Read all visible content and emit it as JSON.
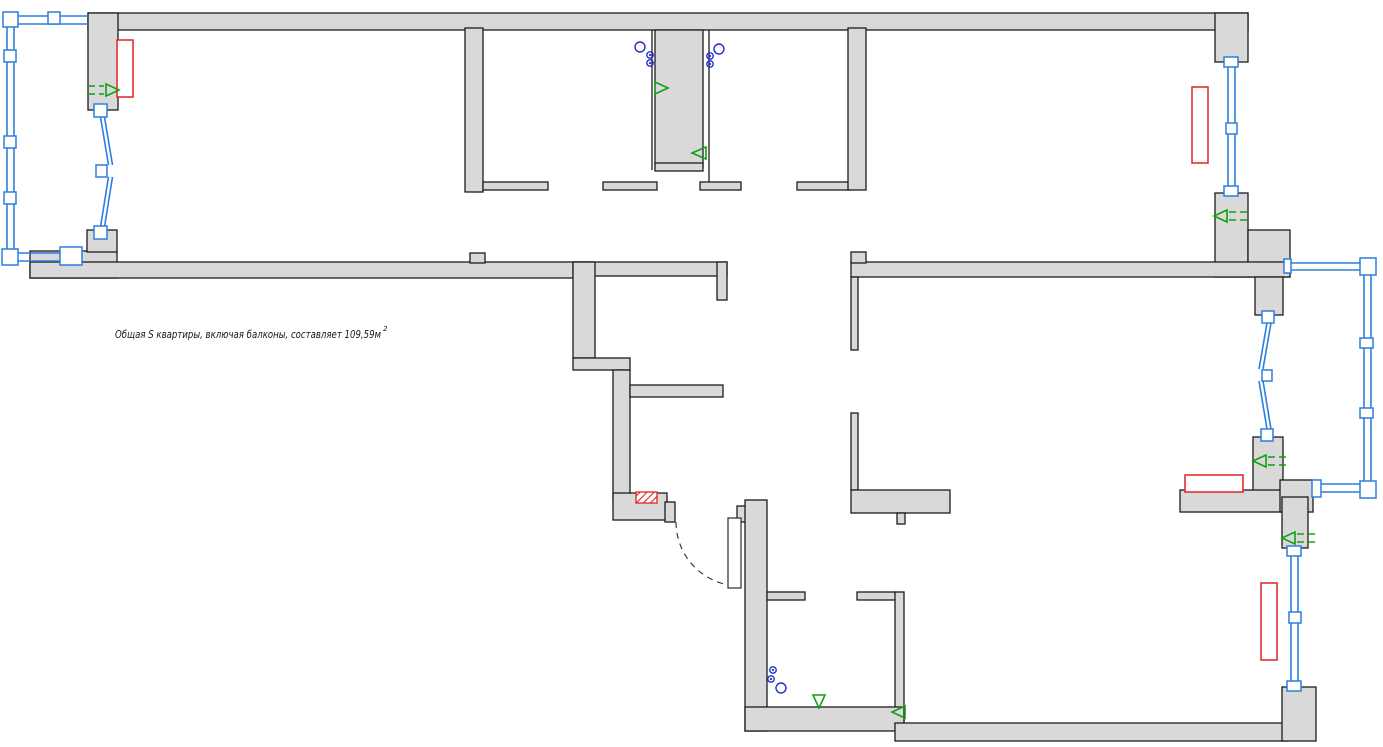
{
  "annotation": {
    "area_label": "Общая S квартиры, включая балконы, составляет 109,59м",
    "area_label_sup": "2",
    "area_value": "109,59",
    "area_units": "м²"
  },
  "colors": {
    "wall_fill": "#d9d9d9",
    "outline": "#1c1c1c",
    "window_blue": "#2e7ede",
    "outlet_blue": "#2230cc",
    "vent_green": "#12a012",
    "radiator_red": "#e02222",
    "door_arc": "#2a2a2a",
    "label_text": "#14141e"
  },
  "symbols": {
    "radiator_count": 4,
    "window_count": 2,
    "glazed_balcony_count": 2,
    "balcony_door_count": 2,
    "entry_door_count": 1,
    "vent_arrow_count": 8,
    "socket_group_count": 3,
    "hatched_panel_count": 1
  }
}
